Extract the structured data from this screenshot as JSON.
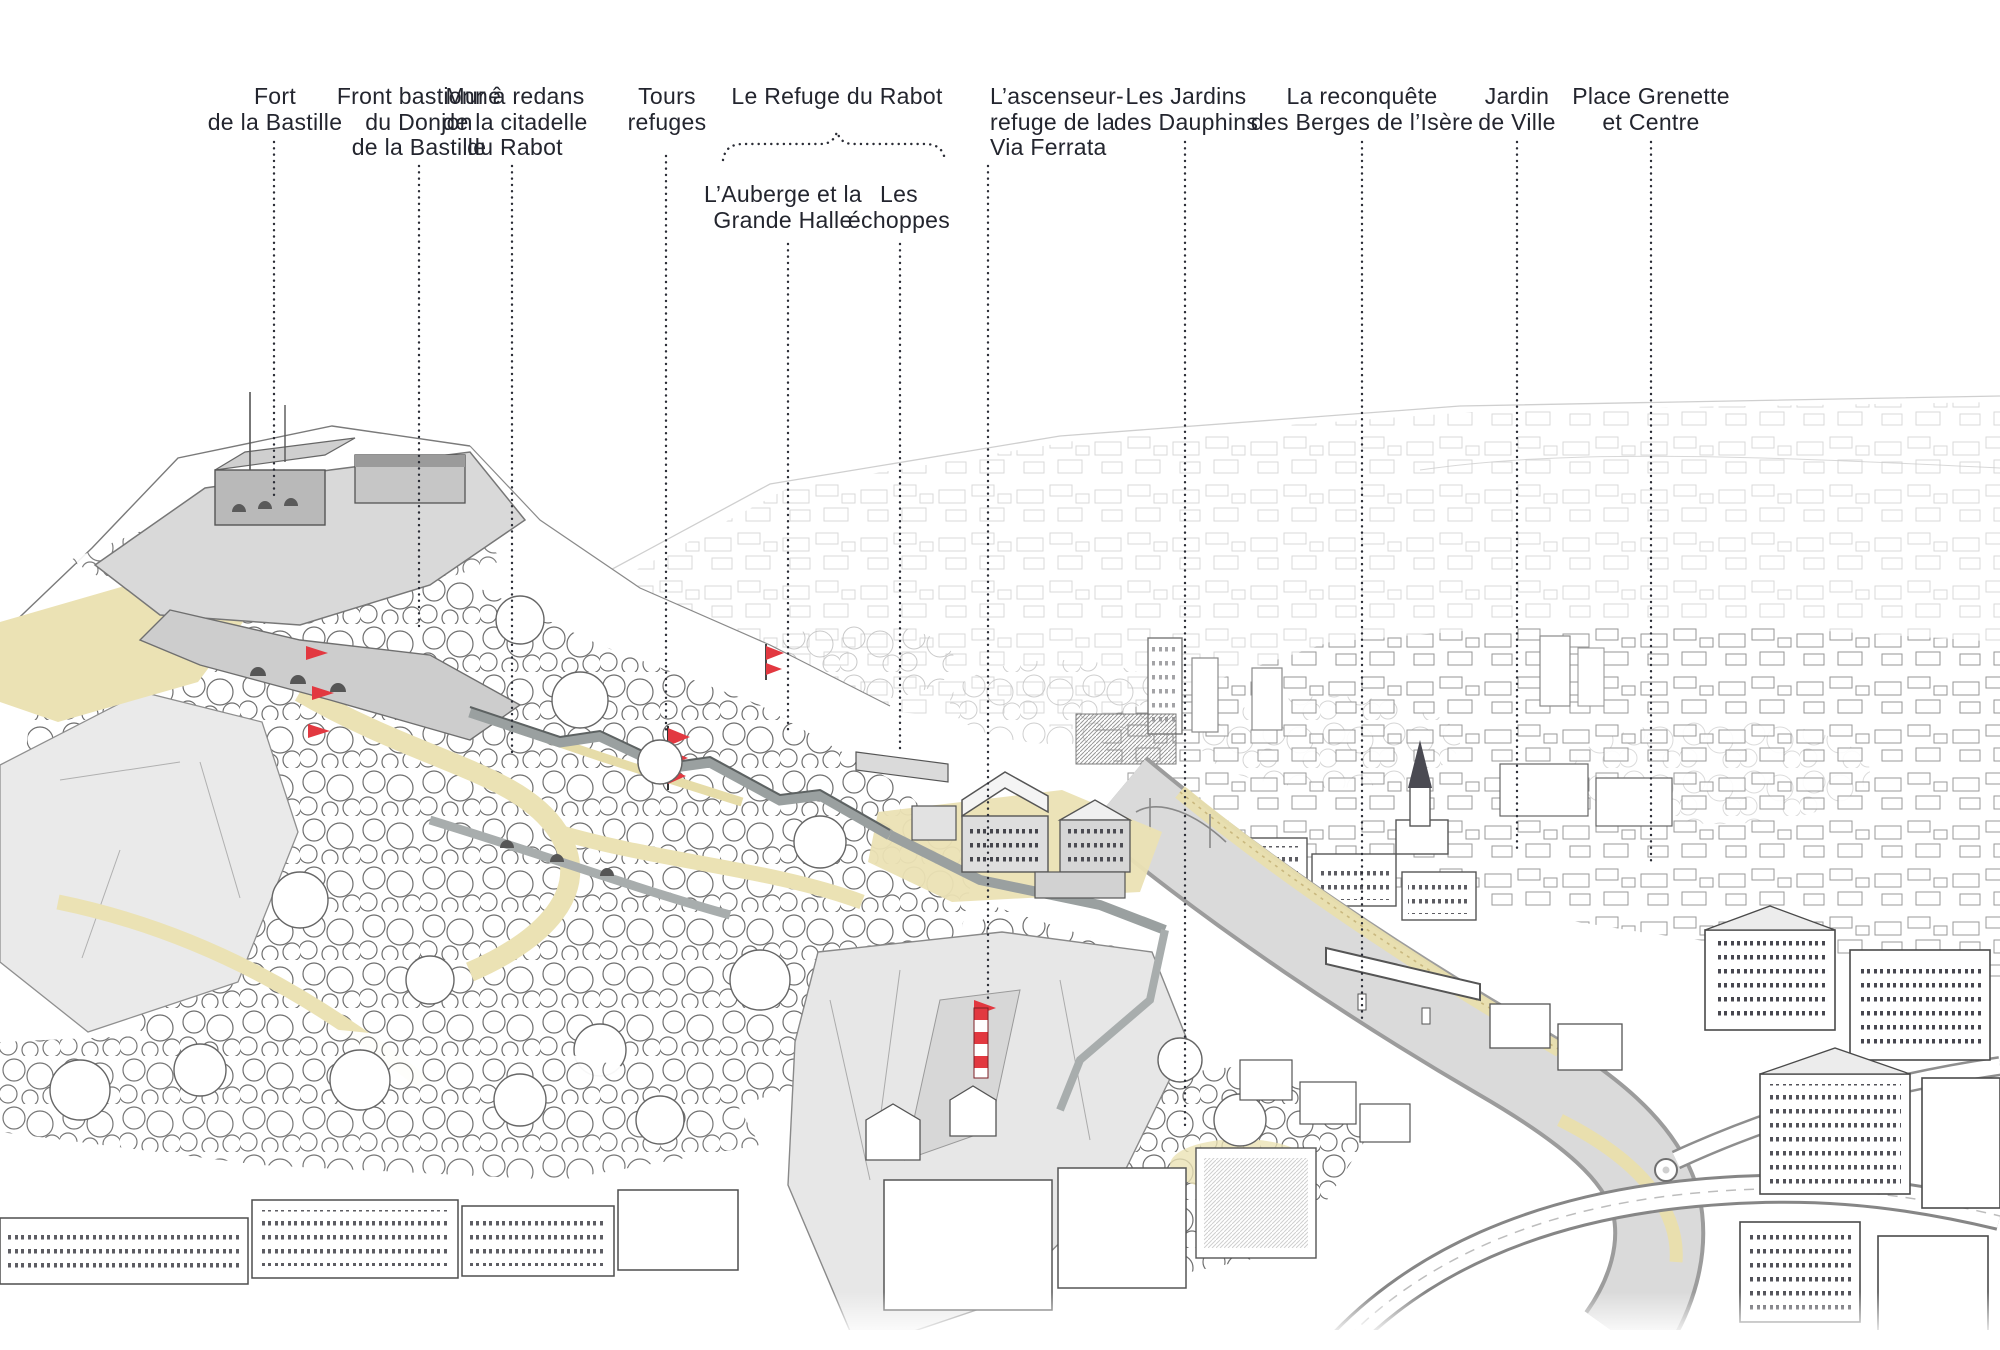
{
  "figure": {
    "accent_colors": {
      "ink": "#23252e",
      "annotation_red": "#e23840",
      "path_tan": "#ebe2b4",
      "wall_gray": "#b9b9b9",
      "river_gray": "#dadada"
    }
  },
  "labels": [
    {
      "id": "fort-de-la-bastille",
      "lines": [
        "Fort",
        "de la Bastille"
      ]
    },
    {
      "id": "front-bastionne",
      "lines": [
        "Front bastionné",
        "du Donjon",
        "de la Bastille"
      ]
    },
    {
      "id": "mur-a-redans",
      "lines": [
        "Mur à redans",
        "de la citadelle",
        "du Rabot"
      ]
    },
    {
      "id": "tours-refuges",
      "lines": [
        "Tours",
        "refuges"
      ]
    },
    {
      "id": "le-refuge-du-rabot",
      "lines": [
        "Le Refuge du Rabot"
      ]
    },
    {
      "id": "auberge-grande-halle",
      "lines": [
        "L’Auberge et la",
        "Grande Halle"
      ]
    },
    {
      "id": "les-echoppes",
      "lines": [
        "Les",
        "échoppes"
      ]
    },
    {
      "id": "ascenseur-via-ferrata",
      "lines": [
        "L’ascenseur-",
        "refuge de la",
        "Via Ferrata"
      ]
    },
    {
      "id": "jardins-des-dauphins",
      "lines": [
        "Les Jardins",
        "des Dauphins"
      ]
    },
    {
      "id": "reconquete-berges",
      "lines": [
        "La reconquête",
        "des Berges de l’Isère"
      ]
    },
    {
      "id": "jardin-de-ville",
      "lines": [
        "Jardin",
        "de Ville"
      ]
    },
    {
      "id": "place-grenette",
      "lines": [
        "Place Grenette",
        "et Centre"
      ]
    }
  ]
}
